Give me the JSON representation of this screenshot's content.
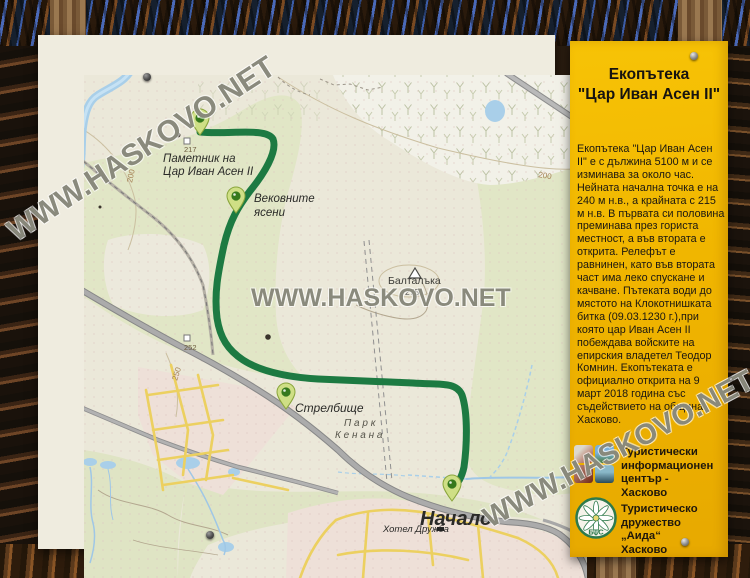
{
  "watermark": {
    "text": "WWW.HASKOVO.NET"
  },
  "panel": {
    "title": [
      "Екопътека",
      "\"Цар Иван Асен II\""
    ],
    "body": "Екопътека \"Цар Иван Асен II\" е с дължина 5100 м и се изминава за около час. Нейната начална точка е на 240 м н.в., а крайната с 215 м н.в. В първата си половина преминава през гориста местност, а във втората е открита. Релефът е равнинен, като във втората част има леко спускане и качване. Пътеката води до мястото на Клокотнишката битка (09.03.1230 г.),при която цар Иван Асен II побеждава войските на епирския владетел Теодор Комнин. Екопътеката е официално открита на 9 март 2018 година със съдействието на община Хасково.",
    "org1": [
      "Туристически",
      "информационен",
      "център - Хасково"
    ],
    "org2": [
      "Туристическо",
      "дружество „Аида“",
      "Хасково"
    ],
    "btc": "БТС"
  },
  "map": {
    "labels": {
      "monument1": "Паметник на",
      "monument2": "Цар Иван Асен II",
      "ashes1": "Вековните",
      "ashes2": "ясени",
      "range": "Стрелбище",
      "start": "Начало",
      "park1": "П а р к",
      "park2": "К е н а н а",
      "hotel": "Хотел Дружба",
      "peak": "Балталъка",
      "peak_elev": "275",
      "spot217": "217",
      "spot252": "252",
      "contour200r": "200",
      "contour200l": "200",
      "contour250": "250"
    },
    "colors": {
      "panel_yellow": "#f0b500",
      "trail_green": "#1d7a42",
      "forest_green": "#e1e6c6",
      "water_blue": "#a9cfe9",
      "urban_pink": "#eee0d8",
      "road_gray": "#ababab",
      "street_yellow": "#ecd060",
      "pin_green": "#cfdf85"
    }
  }
}
